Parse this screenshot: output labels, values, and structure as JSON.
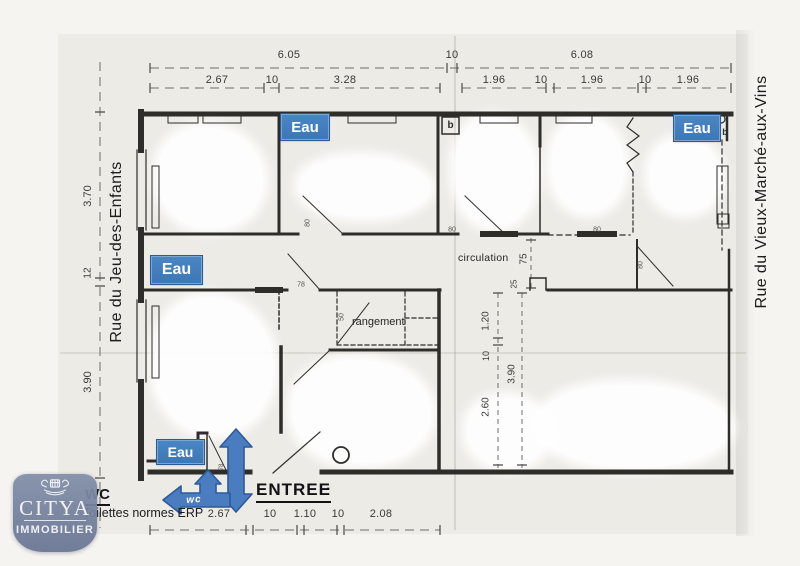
{
  "streets": {
    "left": "Rue du Jeu-des-Enfants",
    "right": "Rue du Vieux-Marché-aux-Vins"
  },
  "logo": {
    "brand": "CITYA",
    "tagline": "IMMOBILIER"
  },
  "plan": {
    "eau": "Eau",
    "b_marker": "b",
    "circulation": "circulation",
    "rangement": "rangement"
  },
  "annotations": {
    "wc_title": "WC",
    "wc_note": "Toilettes normes ERP",
    "entree": "ENTREE",
    "entree_dot": "·",
    "wc_arrow_label": "wc"
  },
  "dims": {
    "top1": [
      "6.05",
      "10",
      "6.08"
    ],
    "top2": [
      "2.67",
      "10",
      "3.28",
      "1.96",
      "10",
      "1.96",
      "10",
      "1.96"
    ],
    "left": [
      "3.70",
      "12",
      "3.90"
    ],
    "bottom": [
      "2.67",
      "10",
      "1.10",
      "10",
      "2.08"
    ],
    "inner": [
      "75",
      "25",
      "1.20",
      "10",
      "3.90",
      "2.60"
    ],
    "small": [
      "80",
      "78",
      "80",
      "80",
      "50",
      "80",
      "78"
    ]
  },
  "colors": {
    "label_blue": "#3c78b5",
    "arrow_blue": "#4a7cc0",
    "arrow_border": "#2d5a9b",
    "logo_slate": "#76819d",
    "wall": "#2e2d2a",
    "dim_text": "#3a3a38"
  }
}
